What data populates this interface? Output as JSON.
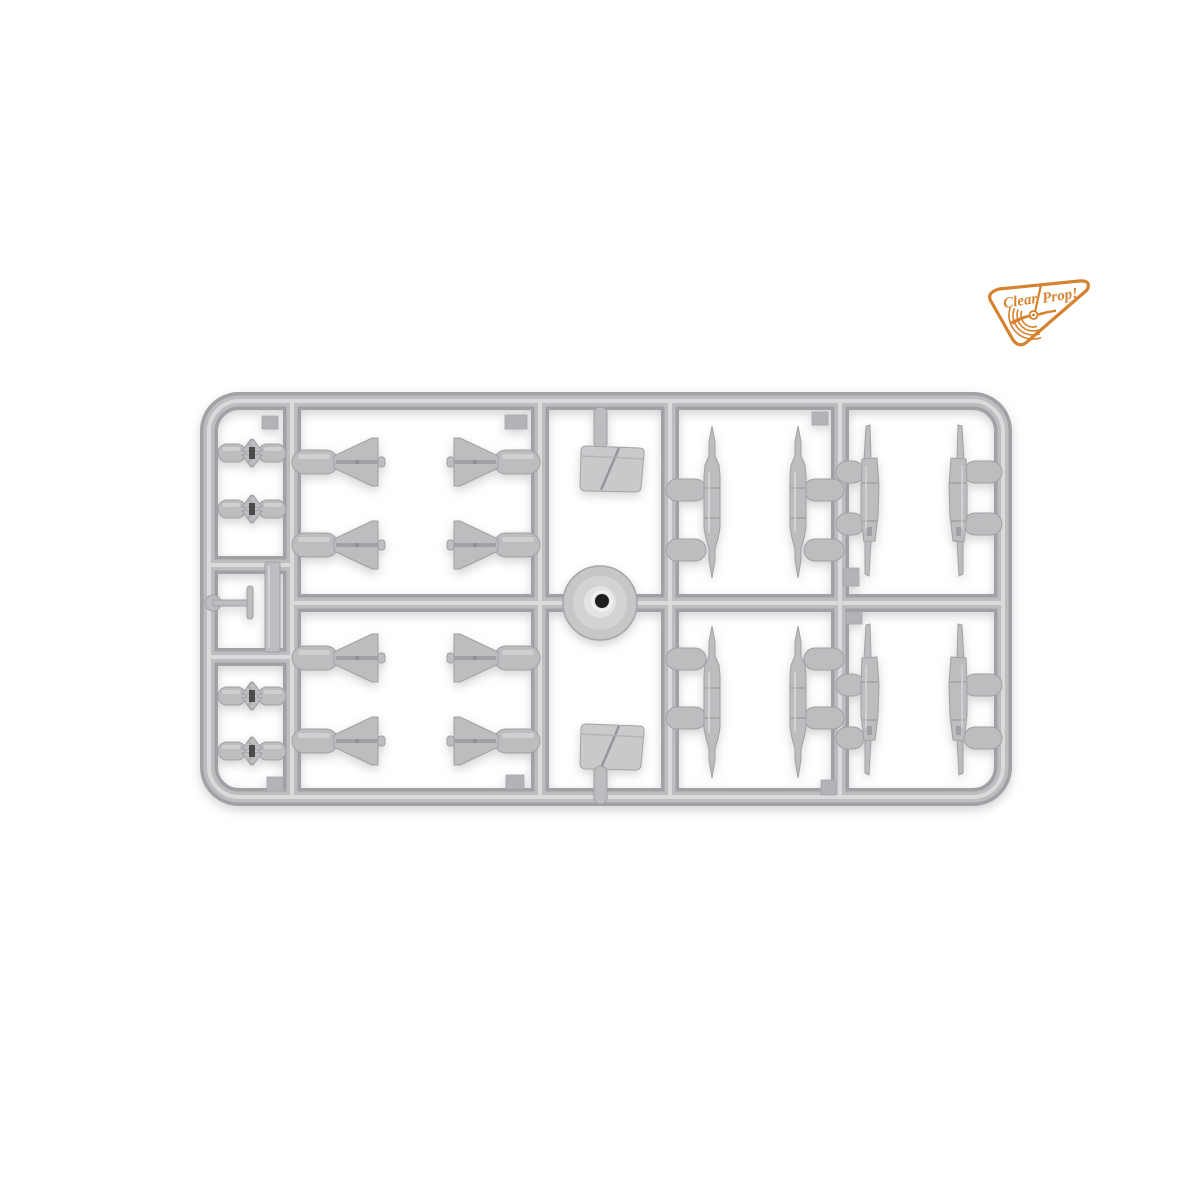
{
  "photo": {
    "type": "product-photo",
    "subject": "light gray injection-molded plastic model kit sprue with ordnance and drop-tank parts on a white background",
    "background_color": "#ffffff",
    "plastic": {
      "base": "#bcbdbf",
      "highlight": "#d9dadc",
      "shadow": "#a0a1a4"
    }
  },
  "logo": {
    "brand": "Clear Prop!",
    "word_left": "Clear",
    "word_right": "Prop!",
    "color": "#d5822f",
    "icon": "propeller-icon"
  },
  "sprue": {
    "frame": "rounded-rectangle runner frame with 4 internal vertical runners, 1 central horizontal runner and 2 left-column crossbars",
    "injection_hub": 1,
    "parts_inventory": [
      {
        "name": "small bomb pair with x-fins",
        "count": 4
      },
      {
        "name": "delta-fin bomb",
        "count": 8
      },
      {
        "name": "slender pointed drop tank",
        "count": 4
      },
      {
        "name": "finned tank half",
        "count": 4
      },
      {
        "name": "canopy / windscreen",
        "count": 2
      },
      {
        "name": "pitot probe",
        "count": 1
      },
      {
        "name": "flat strip",
        "count": 1
      }
    ]
  }
}
